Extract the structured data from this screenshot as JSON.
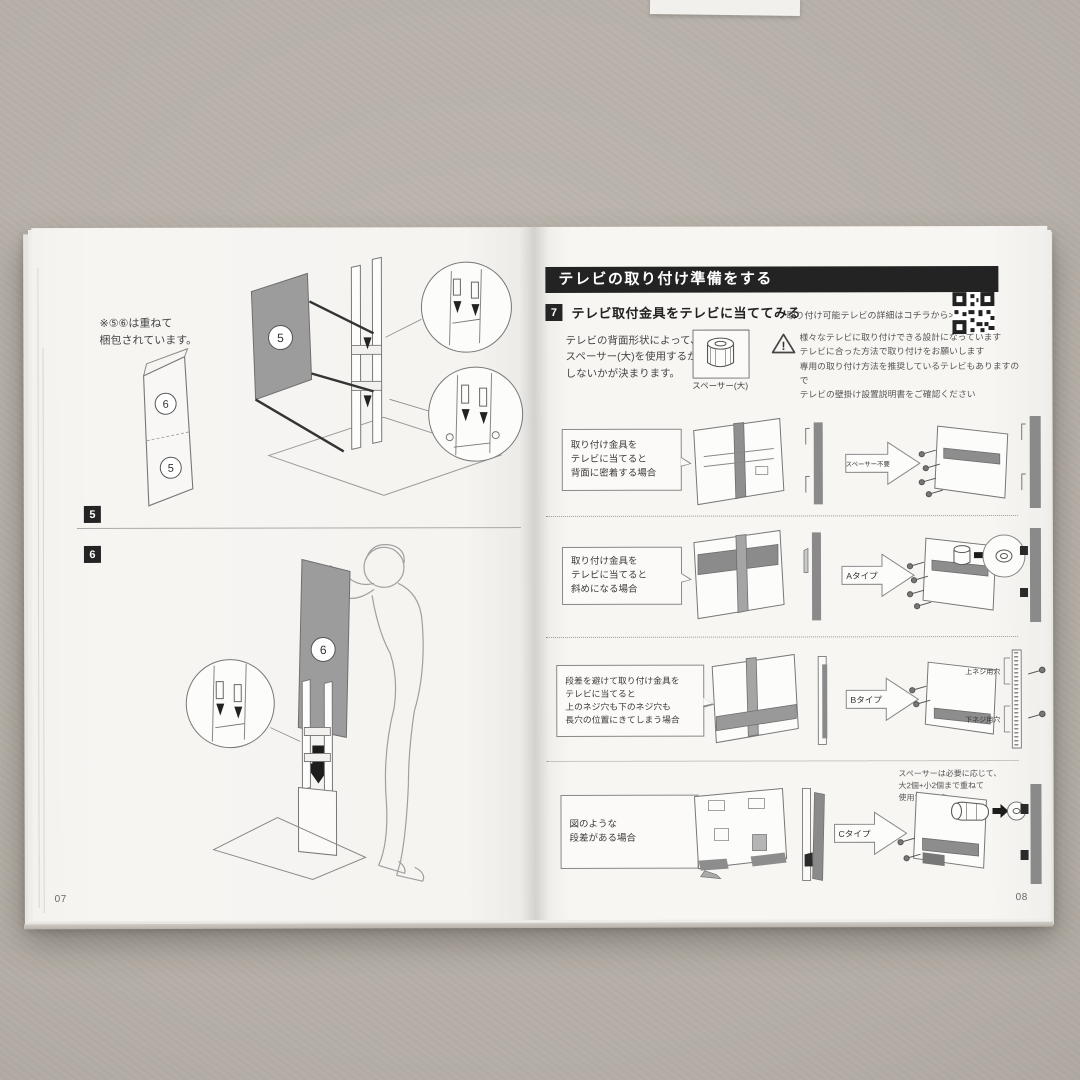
{
  "photo": {
    "surface_color": "#b4aea6",
    "page_color": "#f6f5f2",
    "ink_color": "#232323",
    "panel_gray": "#9c9c9c"
  },
  "left_page": {
    "note": "※⑤⑥は重ねて\n梱包されています。",
    "packaging_top_label": "6",
    "packaging_bottom_label": "5",
    "panel5_label": "5",
    "panel6_label": "6",
    "step5_badge": "5",
    "step6_badge": "6",
    "page_number": "07"
  },
  "right_page": {
    "header": "テレビの取り付け準備をする",
    "step_number": "7",
    "step_title": "テレビ取付金具をテレビに当ててみる",
    "qr_caption": "取り付け可能テレビの詳細はコチラから>",
    "intro_text": "テレビの背面形状によって、\nスペーサー(大)を使用するか\nしないかが決まります。",
    "spacer_label": "スペーサー(大)",
    "warning_text": "様々なテレビに取り付けできる設計になっています\nテレビに合った方法で取り付けをお願いします\n専用の取り付け方法を推奨しているテレビもありますので\nテレビの壁掛け設置説明書をご確認ください",
    "cases": [
      {
        "caption": "取り付け金具を\nテレビに当てると\n背面に密着する場合",
        "result": "スペーサー不要"
      },
      {
        "caption": "取り付け金具を\nテレビに当てると\n斜めになる場合",
        "result": "Aタイプ"
      },
      {
        "caption": "段差を避けて取り付け金具を\nテレビに当てると\n上のネジ穴も下のネジ穴も\n長穴の位置にきてしまう場合",
        "result": "Bタイプ"
      },
      {
        "caption": "図のような\n段差がある場合",
        "result": "Cタイプ"
      }
    ],
    "spacer_note": "スペーサーは必要に応じて、\n大2個+小2個まで重ねて\n使用できます。",
    "hole_upper": "上ネジ用穴",
    "hole_lower": "下ネジ用穴",
    "page_number": "08"
  }
}
